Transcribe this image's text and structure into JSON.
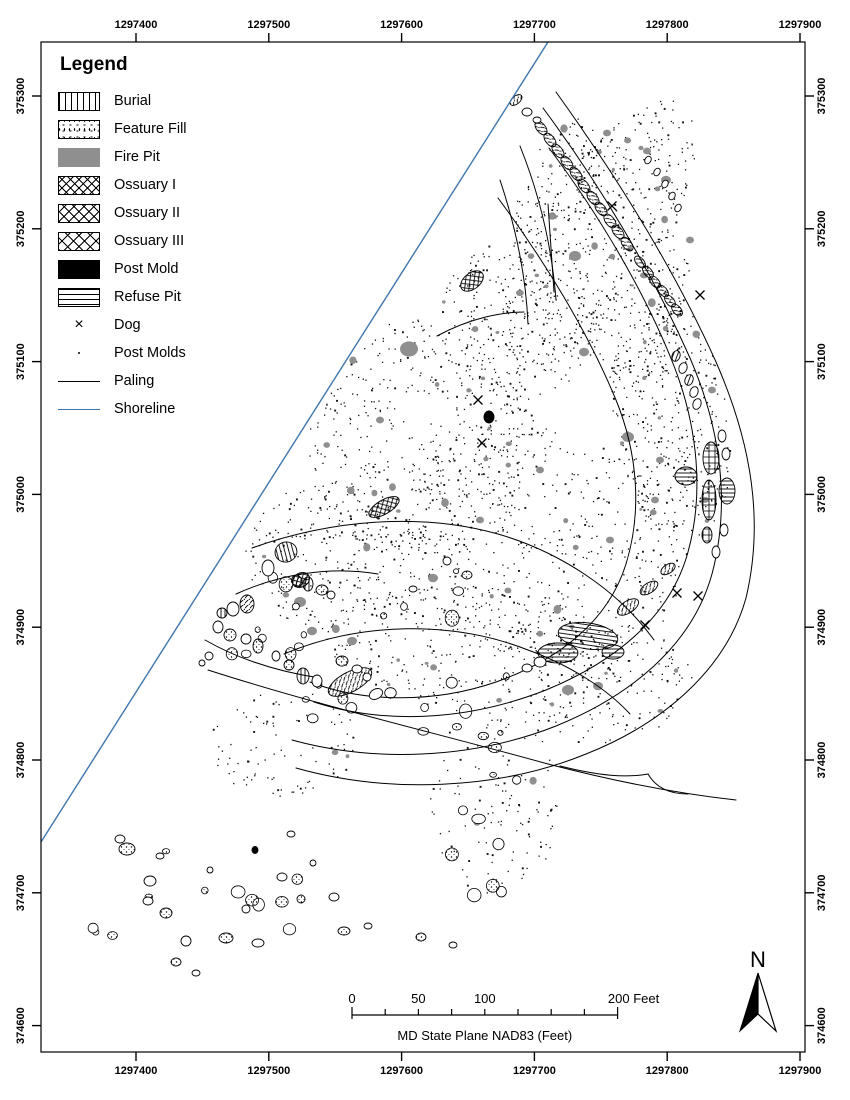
{
  "page": {
    "width": 850,
    "height": 1100,
    "background": "#ffffff"
  },
  "colors": {
    "ink": "#000000",
    "shoreline": "#3f76ad",
    "fire_pit": "#8f8f8f",
    "post_mold_dot": "#111111"
  },
  "legend": {
    "title": "Legend",
    "items": [
      {
        "label": "Burial",
        "pattern": "vert"
      },
      {
        "label": "Feature Fill",
        "pattern": "stipple"
      },
      {
        "label": "Fire Pit",
        "pattern": "gray"
      },
      {
        "label": "Ossuary I",
        "pattern": "cross-a"
      },
      {
        "label": "Ossuary II",
        "pattern": "cross-b"
      },
      {
        "label": "Ossuary III",
        "pattern": "cross-c"
      },
      {
        "label": "Post Mold",
        "pattern": "black"
      },
      {
        "label": "Refuse Pit",
        "pattern": "horiz"
      },
      {
        "label": "Dog",
        "pattern": "x-mark"
      },
      {
        "label": "Post Molds",
        "pattern": "dot"
      },
      {
        "label": "Paling",
        "pattern": "line-black"
      },
      {
        "label": "Shoreline",
        "pattern": "line-blue"
      }
    ]
  },
  "axes": {
    "x_ticks": [
      1297400,
      1297500,
      1297600,
      1297700,
      1297800,
      1297900
    ],
    "y_ticks": [
      375300,
      375200,
      375100,
      375000,
      374900,
      374800,
      374700,
      374600
    ]
  },
  "scalebar": {
    "tick_interval_ft": 25,
    "max_ft": 200,
    "labels": [
      {
        "ft": 0,
        "text": "0"
      },
      {
        "ft": 50,
        "text": "50"
      },
      {
        "ft": 100,
        "text": "100"
      },
      {
        "ft": 200,
        "text": "200 Feet"
      }
    ],
    "caption": "MD State Plane NAD83 (Feet)"
  },
  "north_arrow": {
    "label": "N"
  },
  "map": {
    "seed": 20231,
    "shoreline_px": {
      "x1": 548,
      "y1": 42,
      "x2": 41,
      "y2": 842
    },
    "paling_paths": [
      "M556,92 C612,170 672,264 716,362 C752,444 764,522 746,598 C726,670 662,724 586,754 C498,790 388,794 296,768",
      "M543,108 C598,182 650,268 690,358 C722,432 730,506 712,574 C692,646 630,696 556,726 C470,760 372,762 292,740",
      "M549,148 C600,216 646,294 674,366 C698,428 704,494 688,552 C670,618 614,662 546,690 C464,722 382,724 314,702",
      "M498,198 C544,260 588,332 616,400 C638,454 642,512 626,564 C608,622 558,660 496,682 C432,704 362,702 310,682",
      "M252,548 C330,520 420,512 498,534 C560,552 618,590 654,640",
      "M284,654 C360,622 452,620 528,650 C572,666 608,690 630,714",
      "M208,670 C320,706 440,734 548,764 C640,788 700,796 736,800",
      "M560,766 C600,776 626,778 648,774 C656,788 670,794 688,794",
      "M548,204 L554,292",
      "M236,594 C280,574 330,566 378,574",
      "M520,146 C540,196 552,248 556,300",
      "M500,180 C516,228 526,276 528,324",
      "M437,336 C470,318 502,312 524,312",
      "M205,640 C240,660 280,672 320,678"
    ],
    "features": [
      [
        541,
        128,
        8,
        4.5,
        52,
        "diag"
      ],
      [
        550,
        140,
        8,
        4.5,
        52,
        "diag"
      ],
      [
        558,
        151,
        8,
        4.5,
        52,
        "diag"
      ],
      [
        567,
        163,
        8,
        4.5,
        52,
        "diag"
      ],
      [
        576,
        174,
        8,
        4.5,
        52,
        "diag"
      ],
      [
        584,
        186,
        8,
        4.5,
        52,
        "diag"
      ],
      [
        593,
        198,
        8,
        4.5,
        52,
        "diag"
      ],
      [
        601,
        209,
        8,
        4.5,
        52,
        "diag"
      ],
      [
        610,
        221,
        8,
        4.5,
        52,
        "diag"
      ],
      [
        618,
        232,
        8,
        4.5,
        52,
        "diag"
      ],
      [
        627,
        244,
        8,
        4.5,
        52,
        "diag"
      ],
      [
        640,
        262,
        7,
        4,
        50,
        "diag"
      ],
      [
        648,
        272,
        7,
        4,
        50,
        "diag"
      ],
      [
        655,
        282,
        7,
        4,
        50,
        "diag"
      ],
      [
        663,
        291,
        7,
        4,
        50,
        "diag"
      ],
      [
        670,
        301,
        7,
        4,
        50,
        "diag"
      ],
      [
        677,
        310,
        7,
        4,
        50,
        "diag"
      ],
      [
        676,
        356,
        4,
        5.5,
        20,
        "vert"
      ],
      [
        683,
        368,
        4,
        5.5,
        20,
        "plain"
      ],
      [
        689,
        380,
        4,
        5.5,
        20,
        "vert"
      ],
      [
        694,
        392,
        4,
        5.5,
        20,
        "plain"
      ],
      [
        697,
        404,
        4,
        5.5,
        20,
        "plain"
      ],
      [
        516,
        100,
        7,
        4,
        -40,
        "diag"
      ],
      [
        527,
        112,
        5,
        4,
        0,
        "plain"
      ],
      [
        537,
        120,
        4,
        3,
        0,
        "plain"
      ],
      [
        722,
        436,
        4,
        6,
        0,
        "plain"
      ],
      [
        726,
        454,
        4,
        6,
        0,
        "plain"
      ],
      [
        724,
        530,
        4,
        6,
        0,
        "plain"
      ],
      [
        716,
        552,
        4,
        6,
        0,
        "plain"
      ],
      [
        711,
        458,
        8,
        16,
        0,
        "grid"
      ],
      [
        709,
        500,
        7,
        20,
        0,
        "grid"
      ],
      [
        707,
        535,
        5,
        8,
        0,
        "grid"
      ],
      [
        686,
        476,
        11,
        9,
        0,
        "horiz"
      ],
      [
        727,
        491,
        8,
        13,
        0,
        "horiz"
      ],
      [
        588,
        636,
        30,
        13,
        8,
        "horiz"
      ],
      [
        558,
        653,
        20,
        10,
        0,
        "horiz"
      ],
      [
        613,
        652,
        11,
        7,
        0,
        "horiz"
      ],
      [
        540,
        662,
        6,
        5,
        0,
        "plain"
      ],
      [
        527,
        668,
        5,
        4,
        0,
        "plain"
      ],
      [
        628,
        607,
        12,
        6,
        -33,
        "diag"
      ],
      [
        649,
        588,
        10,
        5,
        -33,
        "diag"
      ],
      [
        668,
        569,
        8,
        4.5,
        -33,
        "diag"
      ],
      [
        350,
        682,
        24,
        10,
        -28,
        "diag"
      ],
      [
        376,
        694,
        7,
        5,
        -28,
        "plain"
      ],
      [
        472,
        281,
        13,
        8,
        -38,
        "cross"
      ],
      [
        384,
        507,
        17,
        7,
        -30,
        "cross"
      ],
      [
        301,
        580,
        9,
        7,
        -30,
        "cross"
      ],
      [
        489,
        417,
        5,
        6,
        0,
        "black"
      ],
      [
        255,
        850,
        3,
        3.5,
        0,
        "black"
      ],
      [
        286,
        552,
        11,
        10,
        -15,
        "vert"
      ],
      [
        268,
        568,
        6,
        8,
        0,
        "plain"
      ],
      [
        297,
        581,
        5,
        6,
        -30,
        "diag"
      ],
      [
        308,
        584,
        5,
        7,
        0,
        "vert"
      ],
      [
        322,
        590,
        6,
        5,
        0,
        "stipple"
      ],
      [
        331,
        595,
        4,
        4,
        0,
        "plain"
      ],
      [
        247,
        604,
        7,
        9,
        0,
        "diag"
      ],
      [
        233,
        609,
        6,
        7,
        0,
        "plain"
      ],
      [
        222,
        613,
        5,
        5,
        0,
        "vert"
      ],
      [
        218,
        627,
        5,
        6,
        0,
        "plain"
      ],
      [
        230,
        635,
        6,
        6,
        0,
        "stipple"
      ],
      [
        246,
        639,
        5,
        5,
        0,
        "plain"
      ],
      [
        258,
        646,
        5,
        7,
        0,
        "stipple"
      ],
      [
        276,
        656,
        4,
        5,
        0,
        "plain"
      ],
      [
        289,
        665,
        5,
        5,
        0,
        "stipple"
      ],
      [
        303,
        676,
        6,
        8,
        0,
        "vert"
      ],
      [
        317,
        681,
        5,
        6,
        0,
        "plain"
      ],
      [
        342,
        661,
        6,
        5,
        0,
        "stipple"
      ],
      [
        357,
        669,
        5,
        4,
        0,
        "plain"
      ],
      [
        367,
        677,
        4,
        4,
        0,
        "plain"
      ],
      [
        209,
        656,
        4,
        4,
        0,
        "plain"
      ],
      [
        202,
        663,
        3,
        3,
        0,
        "plain"
      ],
      [
        467,
        575,
        5,
        4,
        0,
        "stipple"
      ],
      [
        447,
        561,
        4,
        4,
        0,
        "plain"
      ],
      [
        413,
        589,
        4,
        3,
        0,
        "plain"
      ],
      [
        648,
        160,
        3,
        4,
        30,
        "plain"
      ],
      [
        657,
        172,
        3,
        4,
        30,
        "plain"
      ],
      [
        665,
        184,
        3,
        4,
        30,
        "plain"
      ],
      [
        672,
        196,
        3,
        4,
        30,
        "plain"
      ],
      [
        678,
        208,
        3,
        4,
        30,
        "plain"
      ],
      [
        127,
        849,
        8,
        6,
        0,
        "stipple"
      ],
      [
        150,
        881,
        6,
        5,
        0,
        "plain"
      ],
      [
        148,
        901,
        5,
        4,
        0,
        "plain"
      ],
      [
        166,
        913,
        6,
        5,
        0,
        "stipple"
      ],
      [
        186,
        941,
        5,
        5,
        0,
        "plain"
      ],
      [
        176,
        962,
        5,
        4,
        0,
        "stipple"
      ],
      [
        196,
        973,
        4,
        3,
        0,
        "plain"
      ],
      [
        226,
        938,
        7,
        5,
        0,
        "stipple"
      ],
      [
        258,
        943,
        6,
        4,
        0,
        "plain"
      ],
      [
        246,
        909,
        4,
        4,
        0,
        "plain"
      ],
      [
        282,
        877,
        5,
        4,
        0,
        "plain"
      ],
      [
        301,
        899,
        4,
        4,
        0,
        "stipple"
      ],
      [
        313,
        863,
        3,
        3,
        0,
        "plain"
      ],
      [
        334,
        897,
        5,
        4,
        0,
        "plain"
      ],
      [
        344,
        931,
        6,
        4,
        0,
        "stipple"
      ],
      [
        368,
        926,
        4,
        3,
        0,
        "plain"
      ],
      [
        421,
        937,
        5,
        4,
        0,
        "stipple"
      ],
      [
        453,
        945,
        4,
        3,
        0,
        "plain"
      ],
      [
        291,
        834,
        4,
        3,
        0,
        "plain"
      ],
      [
        120,
        839,
        5,
        4,
        0,
        "plain"
      ],
      [
        160,
        856,
        4,
        3,
        0,
        "plain"
      ],
      [
        210,
        870,
        3,
        3,
        0,
        "plain"
      ]
    ],
    "dogs": [
      [
        478,
        400
      ],
      [
        482,
        443
      ],
      [
        645,
        625
      ],
      [
        677,
        593
      ],
      [
        698,
        596
      ],
      [
        700,
        295
      ],
      [
        612,
        206
      ]
    ],
    "fire_pits": [
      [
        409,
        349,
        9
      ],
      [
        575,
        256,
        6
      ],
      [
        628,
        437,
        6
      ],
      [
        584,
        352,
        5
      ],
      [
        300,
        602,
        6
      ],
      [
        312,
        631,
        5
      ],
      [
        352,
        641,
        5
      ],
      [
        568,
        690,
        6
      ],
      [
        433,
        578,
        5
      ],
      [
        598,
        686,
        5
      ],
      [
        712,
        390,
        4
      ],
      [
        666,
        180,
        5
      ],
      [
        647,
        151,
        4
      ],
      [
        607,
        133,
        4
      ],
      [
        690,
        240,
        4
      ],
      [
        655,
        500,
        4
      ],
      [
        540,
        470,
        4
      ],
      [
        380,
        420,
        4
      ],
      [
        480,
        520,
        4
      ],
      [
        610,
        540,
        4
      ],
      [
        660,
        460,
        4
      ]
    ],
    "scatter_zones": [
      {
        "cx": 600,
        "cy": 235,
        "rx": 60,
        "ry": 155,
        "rot": 32,
        "n": 380,
        "gray": 8
      },
      {
        "cx": 672,
        "cy": 420,
        "rx": 58,
        "ry": 125,
        "rot": -8,
        "n": 380,
        "gray": 8
      },
      {
        "cx": 545,
        "cy": 545,
        "rx": 145,
        "ry": 115,
        "rot": 15,
        "n": 520,
        "gray": 9
      },
      {
        "cx": 420,
        "cy": 440,
        "rx": 115,
        "ry": 120,
        "rot": 0,
        "n": 430,
        "gray": 9
      },
      {
        "cx": 330,
        "cy": 555,
        "rx": 85,
        "ry": 75,
        "rot": 0,
        "n": 240,
        "gray": 6
      },
      {
        "cx": 470,
        "cy": 650,
        "rx": 145,
        "ry": 65,
        "rot": 5,
        "n": 300,
        "gray": 7
      },
      {
        "cx": 612,
        "cy": 688,
        "rx": 85,
        "ry": 55,
        "rot": -10,
        "n": 150,
        "gray": 4
      },
      {
        "cx": 495,
        "cy": 800,
        "rx": 65,
        "ry": 95,
        "rot": 0,
        "n": 120,
        "gray": 2
      },
      {
        "cx": 285,
        "cy": 745,
        "rx": 75,
        "ry": 55,
        "rot": 0,
        "n": 90,
        "gray": 2
      },
      {
        "cx": 520,
        "cy": 320,
        "rx": 80,
        "ry": 80,
        "rot": 0,
        "n": 260,
        "gray": 7
      },
      {
        "cx": 560,
        "cy": 180,
        "rx": 35,
        "ry": 70,
        "rot": 30,
        "n": 120,
        "gray": 4
      },
      {
        "cx": 640,
        "cy": 300,
        "rx": 45,
        "ry": 90,
        "rot": 15,
        "n": 160,
        "gray": 5
      }
    ],
    "blob_zones": [
      {
        "cx": 265,
        "cy": 615,
        "rx": 65,
        "ry": 55,
        "n": 10
      },
      {
        "cx": 200,
        "cy": 905,
        "rx": 115,
        "ry": 75,
        "n": 12
      },
      {
        "cx": 490,
        "cy": 720,
        "rx": 75,
        "ry": 55,
        "n": 10
      },
      {
        "cx": 505,
        "cy": 840,
        "rx": 60,
        "ry": 80,
        "n": 8
      },
      {
        "cx": 350,
        "cy": 705,
        "rx": 60,
        "ry": 40,
        "n": 6
      },
      {
        "cx": 430,
        "cy": 600,
        "rx": 60,
        "ry": 40,
        "n": 5
      }
    ]
  }
}
